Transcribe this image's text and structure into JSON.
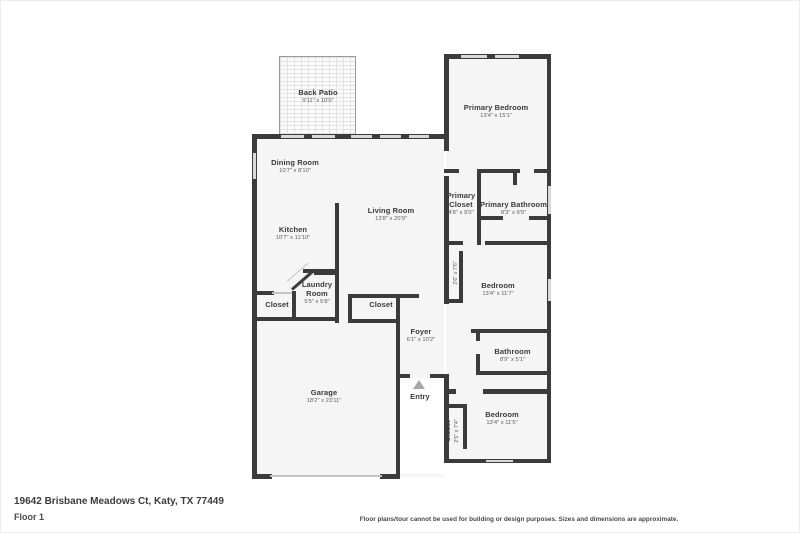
{
  "meta": {
    "address": "19642 Brisbane Meadows Ct, Katy, TX 77449",
    "floor_label": "Floor 1",
    "disclaimer": "Floor plans/tour cannot be used for building or design purposes. Sizes and dimensions are approximate."
  },
  "colors": {
    "wall": "#3b3b3b",
    "room_fill": "#f5f5f5",
    "window": "#d9d9d9",
    "entry_arrow": "#a8a8a8",
    "room_text": "#3a3a3a",
    "dim_text": "#5d5d5d"
  },
  "rooms": [
    {
      "id": "back-patio",
      "name": "Back Patio",
      "dims": "9'11\" x 10'0\""
    },
    {
      "id": "primary-bedroom",
      "name": "Primary Bedroom",
      "dims": "13'4\" x 15'1\""
    },
    {
      "id": "dining-room",
      "name": "Dining Room",
      "dims": "10'7\" x 8'10\""
    },
    {
      "id": "living-room",
      "name": "Living Room",
      "dims": "13'8\" x 20'9\""
    },
    {
      "id": "kitchen",
      "name": "Kitchen",
      "dims": "10'7\" x 11'10\""
    },
    {
      "id": "primary-closet",
      "name": "Primary Closet",
      "dims": "4'8\" x 9'0\""
    },
    {
      "id": "primary-bathroom",
      "name": "Primary Bathroom",
      "dims": "8'3\" x 9'0\""
    },
    {
      "id": "hall-closet",
      "name": "Closet",
      "dims": "2'6\" x 7'6\""
    },
    {
      "id": "bedroom-2",
      "name": "Bedroom",
      "dims": "13'4\" x 11'7\""
    },
    {
      "id": "laundry-room",
      "name": "Laundry Room",
      "dims": "5'5\" x 5'8\""
    },
    {
      "id": "closet-kitchen",
      "name": "Closet",
      "dims": ""
    },
    {
      "id": "closet-foyer",
      "name": "Closet",
      "dims": ""
    },
    {
      "id": "foyer",
      "name": "Foyer",
      "dims": "6'1\" x 10'2\""
    },
    {
      "id": "bathroom",
      "name": "Bathroom",
      "dims": "8'9\" x 5'1\""
    },
    {
      "id": "garage",
      "name": "Garage",
      "dims": "18'2\" x 23'11\""
    },
    {
      "id": "bedroom-3",
      "name": "Bedroom",
      "dims": "13'4\" x 11'5\""
    },
    {
      "id": "closet-3",
      "name": "Closet",
      "dims": "2'5\" x 7'4\""
    },
    {
      "id": "entry",
      "name": "Entry",
      "dims": ""
    }
  ]
}
